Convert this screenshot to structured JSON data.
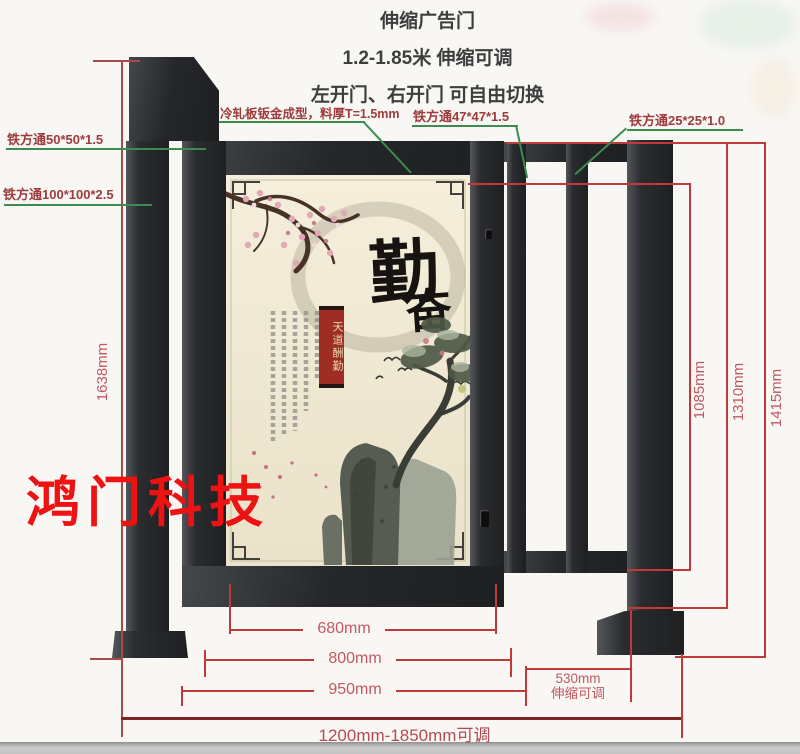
{
  "title": {
    "line1": "伸缩广告门",
    "line2": "1.2-1.85米 伸缩可调",
    "line3": "左开门、右开门 可自由切换"
  },
  "watermark": "鸿门科技",
  "callouts": {
    "tube50": "铁方通50*50*1.5",
    "tube100": "铁方通100*100*2.5",
    "cold_plate": "冷轧板钣金成型，料厚T=1.5mm",
    "tube47": "铁方通47*47*1.5",
    "tube25": "铁方通25*25*1.0"
  },
  "dimensions": {
    "total_height": "1638mm",
    "inner_height": "1085mm",
    "frame_height": "1310mm",
    "pillar_height": "1415mm",
    "panel_width": "680mm",
    "door_width": "800mm",
    "door_section_width": "950mm",
    "telescopic_width": "530mm",
    "telescopic_note": "伸缩可调",
    "total_width": "1200mm-1850mm可调"
  },
  "artwork": {
    "main_char": "勤",
    "sub_char": "奋",
    "banner": "天道酬勤"
  }
}
